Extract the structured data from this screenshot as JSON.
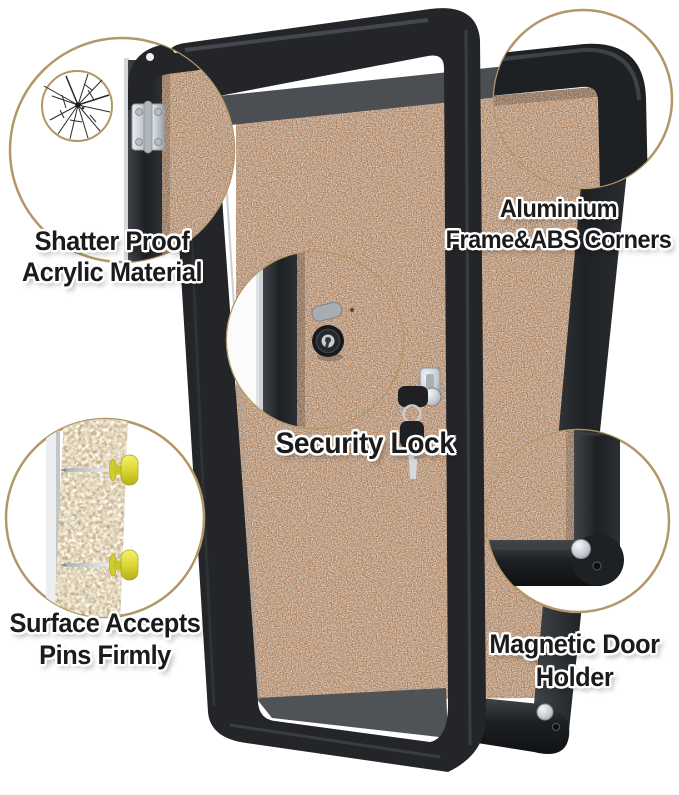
{
  "image_type": "annotated-product-feature-image",
  "labels": {
    "shatter_proof": {
      "line1": "Shatter Proof",
      "line2": "Acrylic Material"
    },
    "aluminium_frame": {
      "line1": "Aluminium",
      "line2": "Frame&ABS Corners"
    },
    "security_lock": {
      "line1": "Security Lock"
    },
    "pins": {
      "line1": "Surface Accepts",
      "line2": "Pins Firmly"
    },
    "magnetic_holder": {
      "line1": "Magnetic Door",
      "line2": "Holder"
    }
  },
  "callouts": [
    {
      "name": "shatter-proof-acrylic",
      "icon": "cracked-acrylic-hinge-icon"
    },
    {
      "name": "aluminium-frame-corner",
      "icon": "frame-corner-icon"
    },
    {
      "name": "security-lock",
      "icon": "lock-cylinder-icon"
    },
    {
      "name": "pin-surface",
      "icon": "push-pins-cork-section-icon"
    },
    {
      "name": "magnetic-door-holder",
      "icon": "magnet-corner-icon"
    }
  ],
  "colors": {
    "background": "#ffffff",
    "cork": "#c78f63",
    "cork_section": "#dfc79e",
    "frame_black": "#222528",
    "frame_gray": "#515559",
    "callout_border": "#b29768",
    "pin_yellow": "#e2de3e",
    "metal_silver": "#d6dade",
    "label_text": "#1b1b1b",
    "label_outline": "#ffffff"
  }
}
